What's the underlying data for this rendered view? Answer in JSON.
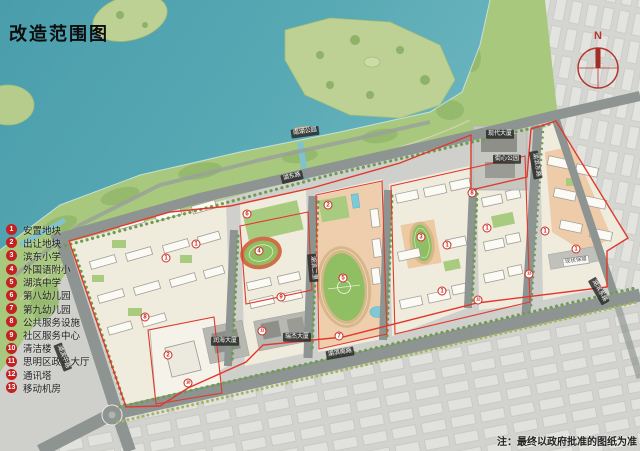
{
  "title": "改造范围图",
  "note": "注：最终以政府批准的图纸为准",
  "compass_label": "N",
  "legend": {
    "items": [
      {
        "num": "1",
        "label": "安置地块"
      },
      {
        "num": "2",
        "label": "出让地块"
      },
      {
        "num": "3",
        "label": "滨东小学"
      },
      {
        "num": "4",
        "label": "外国语附小"
      },
      {
        "num": "5",
        "label": "湖滨中学"
      },
      {
        "num": "6",
        "label": "第八幼儿园"
      },
      {
        "num": "7",
        "label": "第九幼儿园"
      },
      {
        "num": "8",
        "label": "公共服务设施"
      },
      {
        "num": "9",
        "label": "社区服务中心"
      },
      {
        "num": "10",
        "label": "清洁楼"
      },
      {
        "num": "11",
        "label": "思明区政务大厅"
      },
      {
        "num": "12",
        "label": "通讯塔"
      },
      {
        "num": "13",
        "label": "移动机房"
      }
    ]
  },
  "map_labels": [
    {
      "text": "南湖公园",
      "x": 305,
      "y": 132,
      "rot": -8,
      "kind": "tag"
    },
    {
      "text": "湖东路",
      "x": 292,
      "y": 177,
      "rot": -14,
      "kind": "road"
    },
    {
      "text": "湖滨中路",
      "x": 63,
      "y": 357,
      "rot": 68,
      "kind": "road"
    },
    {
      "text": "湖滨南路",
      "x": 340,
      "y": 353,
      "rot": -10,
      "kind": "road"
    },
    {
      "text": "湖滨东路",
      "x": 536,
      "y": 165,
      "rot": 80,
      "kind": "road"
    },
    {
      "text": "湖滨二里",
      "x": 313,
      "y": 268,
      "rot": 85,
      "kind": "road"
    },
    {
      "text": "湖滨东路",
      "x": 599,
      "y": 291,
      "rot": 60,
      "kind": "road"
    },
    {
      "text": "现代大厦",
      "x": 500,
      "y": 134,
      "rot": 0,
      "kind": "tag"
    },
    {
      "text": "街心公园",
      "x": 507,
      "y": 159,
      "rot": 0,
      "kind": "tag"
    },
    {
      "text": "润海大厦",
      "x": 225,
      "y": 341,
      "rot": 0,
      "kind": "tag"
    },
    {
      "text": "瑞杰大厦",
      "x": 297,
      "y": 337,
      "rot": 0,
      "kind": "tag"
    },
    {
      "text": "现状保留",
      "x": 576,
      "y": 261,
      "rot": -8,
      "kind": "tag-light"
    }
  ],
  "map_markers": [
    {
      "num": "1",
      "x": 196,
      "y": 244
    },
    {
      "num": "1",
      "x": 166,
      "y": 258
    },
    {
      "num": "8",
      "x": 145,
      "y": 317
    },
    {
      "num": "2",
      "x": 168,
      "y": 355
    },
    {
      "num": "10",
      "x": 188,
      "y": 383
    },
    {
      "num": "6",
      "x": 247,
      "y": 214
    },
    {
      "num": "4",
      "x": 259,
      "y": 251
    },
    {
      "num": "9",
      "x": 281,
      "y": 297
    },
    {
      "num": "11",
      "x": 262,
      "y": 331
    },
    {
      "num": "2",
      "x": 328,
      "y": 205
    },
    {
      "num": "5",
      "x": 343,
      "y": 278
    },
    {
      "num": "7",
      "x": 339,
      "y": 336
    },
    {
      "num": "3",
      "x": 421,
      "y": 237
    },
    {
      "num": "1",
      "x": 447,
      "y": 245
    },
    {
      "num": "1",
      "x": 442,
      "y": 291
    },
    {
      "num": "12",
      "x": 478,
      "y": 300
    },
    {
      "num": "8",
      "x": 472,
      "y": 193
    },
    {
      "num": "1",
      "x": 487,
      "y": 228
    },
    {
      "num": "13",
      "x": 529,
      "y": 274
    },
    {
      "num": "1",
      "x": 545,
      "y": 231
    },
    {
      "num": "1",
      "x": 576,
      "y": 249
    }
  ],
  "colors": {
    "boundary_red": "#e2382b",
    "legend_red": "#c32222",
    "water": "#4d9fab",
    "park_green": "#a8c87e",
    "field_green": "#8fbf62",
    "track_tan": "#d8b88a",
    "track_red": "#cf6f4a",
    "school_pink": "#edc9a4",
    "road_gray": "#8d9492",
    "city_gray": "#d6d7d3"
  }
}
